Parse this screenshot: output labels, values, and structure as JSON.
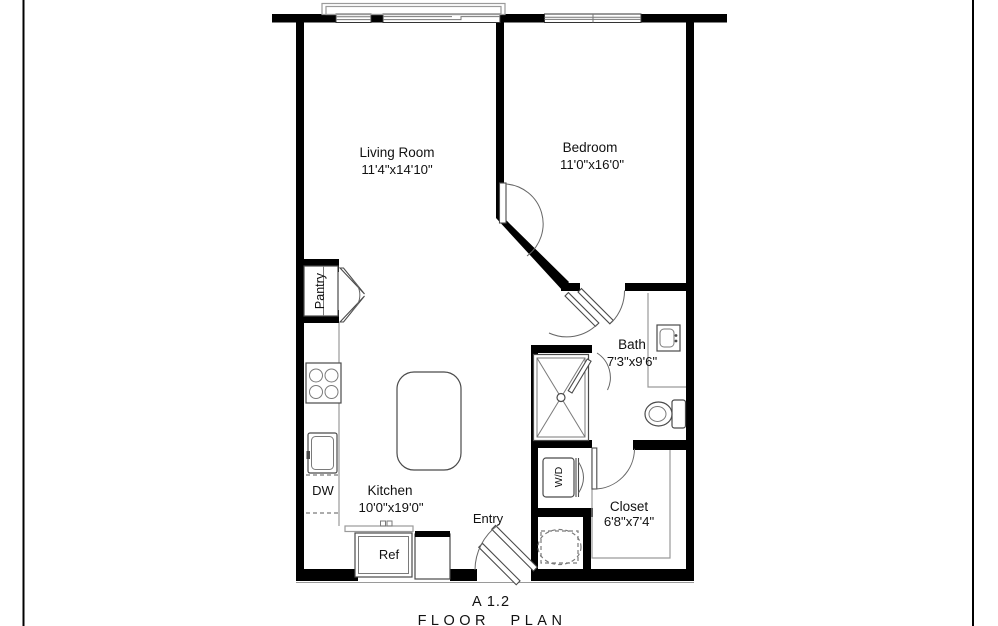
{
  "title": {
    "plan_code": "A 1.2",
    "plan_label": "FLOOR PLAN"
  },
  "rooms": {
    "living_room": {
      "name": "Living Room",
      "dims": "11'4\"x14'10\""
    },
    "bedroom": {
      "name": "Bedroom",
      "dims": "11'0\"x16'0\""
    },
    "bath": {
      "name": "Bath",
      "dims": "7'3\"x9'6\""
    },
    "kitchen": {
      "name": "Kitchen",
      "dims": "10'0\"x19'0\""
    },
    "closet": {
      "name": "Closet",
      "dims": "6'8\"x7'4\""
    },
    "entry": {
      "name": "Entry"
    }
  },
  "fixtures": {
    "pantry": "Pantry",
    "dishwasher": "DW",
    "refrigerator": "Ref",
    "washer_dryer": "W/D"
  },
  "colors": {
    "wall": "#000000",
    "fixture_line": "#4a4a4a",
    "light_line": "#9a9a9a",
    "text": "#111111",
    "background": "#ffffff"
  }
}
